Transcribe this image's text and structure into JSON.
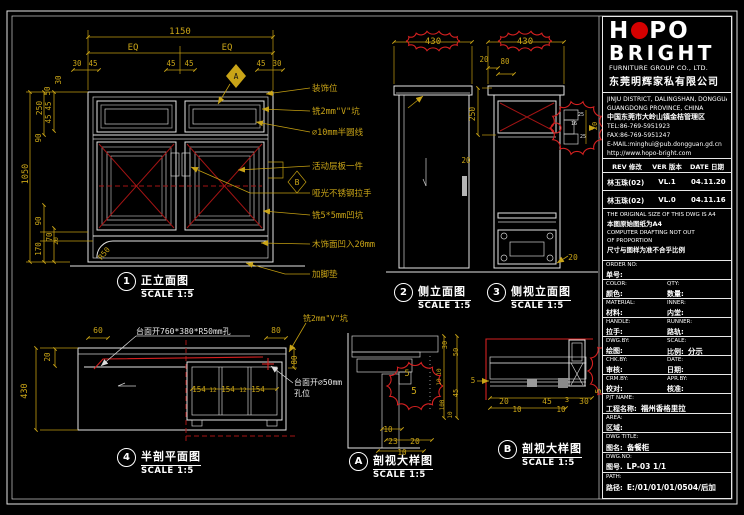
{
  "colors": {
    "dim": "#c9a417",
    "line": "#e8e8e8",
    "red": "#d42020",
    "black": "#141414"
  },
  "views": [
    {
      "num": "1",
      "title": "正立面图",
      "scale": "SCALE 1:5"
    },
    {
      "num": "2",
      "title": "侧立面图",
      "scale": "SCALE 1:5"
    },
    {
      "num": "3",
      "title": "侧视立面图",
      "scale": "SCALE 1:5"
    },
    {
      "num": "4",
      "title": "半剖平面图",
      "scale": "SCALE 1:5"
    },
    {
      "num": "A",
      "title": "剖视大样图",
      "scale": "SCALE 1:5"
    },
    {
      "num": "B",
      "title": "剖视大样图",
      "scale": "SCALE 1:5"
    }
  ],
  "svg_labels": [
    {
      "t": "1150",
      "x": 180,
      "y": 34
    },
    {
      "t": "EQ",
      "x": 133,
      "y": 50
    },
    {
      "t": "EQ",
      "x": 227,
      "y": 50
    },
    {
      "t": "30",
      "x": 77,
      "y": 66,
      "s": 7.5
    },
    {
      "t": "45",
      "x": 93,
      "y": 66,
      "s": 7.5
    },
    {
      "t": "45",
      "x": 171,
      "y": 66,
      "s": 7.5
    },
    {
      "t": "45",
      "x": 189,
      "y": 66,
      "s": 7.5
    },
    {
      "t": "45",
      "x": 261,
      "y": 66,
      "s": 7.5
    },
    {
      "t": "30",
      "x": 277,
      "y": 66,
      "s": 7.5
    },
    {
      "t": "30",
      "x": 61,
      "y": 80,
      "r": -90,
      "s": 7.5
    },
    {
      "t": "50",
      "x": 50,
      "y": 91,
      "r": -90,
      "s": 7.5
    },
    {
      "t": "45",
      "x": 51,
      "y": 106,
      "r": -90,
      "s": 7.5
    },
    {
      "t": "45",
      "x": 51,
      "y": 119,
      "r": -90,
      "s": 7.5
    },
    {
      "t": "250",
      "x": 42,
      "y": 108,
      "r": -90,
      "s": 8
    },
    {
      "t": "90",
      "x": 41,
      "y": 138,
      "r": -90,
      "s": 7.5
    },
    {
      "t": "1050",
      "x": 28,
      "y": 174,
      "r": -90,
      "s": 8.5
    },
    {
      "t": "90",
      "x": 41,
      "y": 221,
      "r": -90,
      "s": 7.5
    },
    {
      "t": "70",
      "x": 52,
      "y": 237,
      "r": -90,
      "s": 7.5
    },
    {
      "t": "20",
      "x": 58,
      "y": 241,
      "r": -90,
      "s": 6.5
    },
    {
      "t": "170",
      "x": 41,
      "y": 249,
      "r": -90,
      "s": 7.5
    },
    {
      "t": "R50",
      "x": 106,
      "y": 255,
      "r": -50,
      "s": 7.5
    },
    {
      "t": "A",
      "x": 236,
      "y": 79,
      "c": "black",
      "s": 8
    },
    {
      "t": "B",
      "x": 297,
      "y": 185,
      "s": 8
    },
    {
      "t": "装饰位",
      "x": 312,
      "y": 91,
      "s": 8.5,
      "a": "start"
    },
    {
      "t": "铣2mm\"V\"坑",
      "x": 312,
      "y": 114,
      "s": 8.5,
      "a": "start"
    },
    {
      "t": "∅10mm半圆线",
      "x": 312,
      "y": 135,
      "s": 8.5,
      "a": "start"
    },
    {
      "t": "活动层板一件",
      "x": 312,
      "y": 169,
      "s": 8.5,
      "a": "start"
    },
    {
      "t": "哑光不锈钢拉手",
      "x": 312,
      "y": 196,
      "s": 8.5,
      "a": "start"
    },
    {
      "t": "铣5*5mm凹坑",
      "x": 312,
      "y": 218,
      "s": 8.5,
      "a": "start"
    },
    {
      "t": "木饰面凹入20mm",
      "x": 312,
      "y": 247,
      "s": 8.5,
      "a": "start"
    },
    {
      "t": "加脚垫",
      "x": 312,
      "y": 277,
      "s": 8.5,
      "a": "start"
    },
    {
      "t": "430",
      "x": 433,
      "y": 44
    },
    {
      "t": "20",
      "x": 466,
      "y": 163,
      "s": 7.5
    },
    {
      "t": "430",
      "x": 525,
      "y": 44
    },
    {
      "t": "20",
      "x": 484,
      "y": 62,
      "s": 7.5
    },
    {
      "t": "80",
      "x": 505,
      "y": 64,
      "s": 7.5
    },
    {
      "t": "250",
      "x": 475,
      "y": 114,
      "r": -90,
      "s": 8
    },
    {
      "t": "20",
      "x": 573,
      "y": 260,
      "s": 8
    },
    {
      "t": "25",
      "x": 581,
      "y": 116,
      "c": "line",
      "s": 5
    },
    {
      "t": "16",
      "x": 574,
      "y": 125,
      "c": "line",
      "s": 5
    },
    {
      "t": "25",
      "x": 583,
      "y": 138,
      "c": "line",
      "s": 5
    },
    {
      "t": "20",
      "x": 597,
      "y": 126,
      "r": -90,
      "s": 7
    },
    {
      "t": "60",
      "x": 98,
      "y": 333,
      "s": 8
    },
    {
      "t": "80",
      "x": 276,
      "y": 333,
      "s": 8
    },
    {
      "t": "20",
      "x": 50,
      "y": 357,
      "r": -90,
      "s": 7.5
    },
    {
      "t": "430",
      "x": 27,
      "y": 391,
      "r": -90,
      "s": 8.5
    },
    {
      "t": "80",
      "x": 297,
      "y": 360,
      "r": -90,
      "s": 7.5
    },
    {
      "t": "154",
      "x": 199,
      "y": 392,
      "s": 7.5
    },
    {
      "t": "12",
      "x": 213,
      "y": 392,
      "s": 6
    },
    {
      "t": "154",
      "x": 228,
      "y": 392,
      "s": 7.5
    },
    {
      "t": "12",
      "x": 243,
      "y": 392,
      "s": 6
    },
    {
      "t": "154",
      "x": 258,
      "y": 392,
      "s": 7.5
    },
    {
      "t": "台面开760*380*R50mm孔",
      "x": 136,
      "y": 334,
      "c": "line",
      "s": 8,
      "a": "start"
    },
    {
      "t": "台面开∅50mm",
      "x": 294,
      "y": 385,
      "c": "line",
      "s": 8,
      "a": "start"
    },
    {
      "t": "孔位",
      "x": 294,
      "y": 396,
      "c": "line",
      "s": 8,
      "a": "start"
    },
    {
      "t": "铣2mm\"V\"坑",
      "x": 303,
      "y": 321,
      "s": 8,
      "a": "start"
    },
    {
      "t": "30",
      "x": 447,
      "y": 345,
      "r": -90,
      "s": 7
    },
    {
      "t": "50",
      "x": 458,
      "y": 352,
      "r": -90,
      "s": 7
    },
    {
      "t": "10",
      "x": 441,
      "y": 372,
      "r": -90,
      "s": 6
    },
    {
      "t": "10",
      "x": 441,
      "y": 382,
      "r": -90,
      "s": 6
    },
    {
      "t": "45",
      "x": 458,
      "y": 393,
      "r": -90,
      "s": 7
    },
    {
      "t": "100",
      "x": 444,
      "y": 405,
      "r": -90,
      "s": 6
    },
    {
      "t": "10",
      "x": 452,
      "y": 415,
      "r": -90,
      "s": 6
    },
    {
      "t": "5",
      "x": 407,
      "y": 376,
      "s": 8.5
    },
    {
      "t": "5",
      "x": 414,
      "y": 394,
      "s": 9.5
    },
    {
      "t": "10",
      "x": 388,
      "y": 432,
      "s": 7.5
    },
    {
      "t": "23",
      "x": 393,
      "y": 444,
      "s": 8
    },
    {
      "t": "20",
      "x": 415,
      "y": 444,
      "s": 8
    },
    {
      "t": "10",
      "x": 402,
      "y": 455,
      "s": 7.5
    },
    {
      "t": "5",
      "x": 473,
      "y": 383,
      "s": 7.5
    },
    {
      "t": "20",
      "x": 504,
      "y": 404,
      "s": 8
    },
    {
      "t": "10",
      "x": 517,
      "y": 412,
      "s": 7.5
    },
    {
      "t": "45",
      "x": 547,
      "y": 404,
      "s": 8
    },
    {
      "t": "3",
      "x": 567,
      "y": 402,
      "s": 7
    },
    {
      "t": "10",
      "x": 561,
      "y": 412,
      "s": 7.5
    },
    {
      "t": "30",
      "x": 584,
      "y": 404,
      "s": 8
    },
    {
      "t": "23",
      "x": 612,
      "y": 372,
      "r": -90,
      "s": 8
    },
    {
      "t": "5",
      "x": 601,
      "y": 391,
      "r": -90,
      "s": 8
    }
  ],
  "title_block": {
    "logo": {
      "h": "H",
      "po": "PO",
      "line2": "BRIGHT",
      "sub": "FURNITURE GROUP CO., LTD.",
      "cn": "东莞明辉家私有限公司"
    },
    "address": [
      "JINJU DISTRICT, DALINGSHAN, DONGGUAN",
      "GUANGDONG PROVINCE, CHINA",
      "中国东莞市大岭山镇金桔管理区",
      "TEL:86-769-5951923",
      "FAX:86-769-5951247",
      "E-MAIL:minghui@pub.dongguan.gd.cn",
      "http://www.hopo-bright.com"
    ],
    "rev": {
      "headers": [
        "REV 修改",
        "VER 版本",
        "DATE 日期"
      ],
      "rows": [
        [
          "林玉珠(02)",
          "VL.1",
          "04.11.20"
        ],
        [
          "林玉珠(02)",
          "VL.0",
          "04.11.16"
        ]
      ]
    },
    "notes": [
      "THE ORIGINAL SIZE OF THIS DWG IS A4",
      "本图原始图纸为A4",
      "COMPUTER DRAFTING NOT OUT",
      "OF PROPORTION",
      "尺寸与图样为准不合乎比例"
    ],
    "fields": [
      {
        "l1": "ORDER NO:",
        "l2": "单号:",
        "r1": "",
        "r2": "",
        "lv": "",
        "rv": ""
      },
      {
        "l1": "COLOR:",
        "l2": "颜色:",
        "r1": "QTY:",
        "r2": "数量:",
        "lv": "",
        "rv": ""
      },
      {
        "l1": "MATERIAL:",
        "l2": "材料:",
        "r1": "INNER:",
        "r2": "内堂:",
        "lv": "",
        "rv": ""
      },
      {
        "l1": "HANDLE:",
        "l2": "拉手:",
        "r1": "RUNNER:",
        "r2": "路轨:",
        "lv": "",
        "rv": ""
      },
      {
        "l1": "DWG.BY:",
        "l2": "绘图:",
        "r1": "SCALE:",
        "r2": "比例:",
        "lv": "",
        "rv": "分示"
      },
      {
        "l1": "CHK.BY:",
        "l2": "审核:",
        "r1": "DATE:",
        "r2": "日期:",
        "lv": "",
        "rv": ""
      },
      {
        "l1": "CRM.BY:",
        "l2": "校对:",
        "r1": "APR.BY:",
        "r2": "核准:",
        "lv": "",
        "rv": ""
      },
      {
        "l1": "PJT NAME:",
        "l2": "工程名称:",
        "r1": "",
        "r2": "",
        "lv": "福州香格里拉",
        "rv": ""
      },
      {
        "l1": "AREA:",
        "l2": "区域:",
        "r1": "",
        "r2": "",
        "lv": "",
        "rv": ""
      },
      {
        "l1": "DWG TITLE:",
        "l2": "图名:",
        "r1": "",
        "r2": "",
        "lv": "备餐柜",
        "rv": ""
      },
      {
        "l1": "DWG.NO:",
        "l2": "图号.",
        "r1": "",
        "r2": "",
        "lv": "LP-03  1/1",
        "rv": ""
      },
      {
        "l1": "PATH:",
        "l2": "路径:",
        "r1": "",
        "r2": "",
        "lv": "E:/01/01/01/0504/后加",
        "rv": ""
      }
    ]
  }
}
